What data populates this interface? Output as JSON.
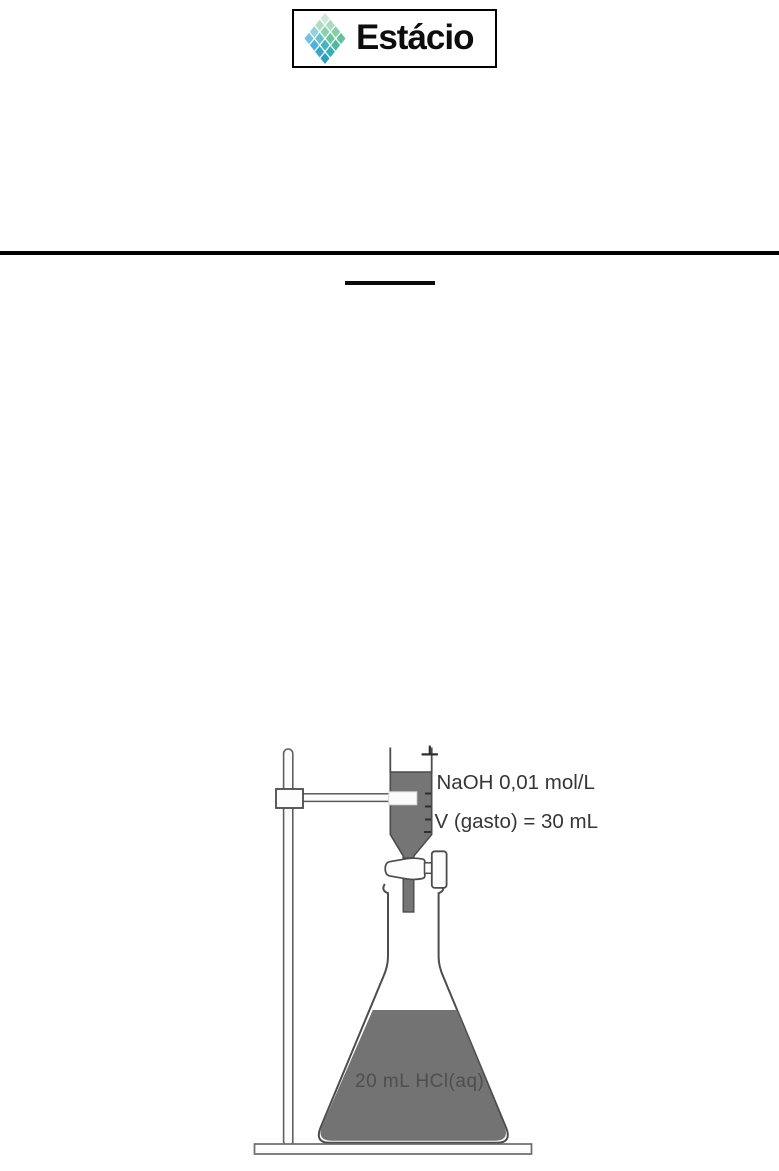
{
  "header": {
    "logo_text": "Estácio"
  },
  "figure": {
    "type": "titration-apparatus-diagram",
    "burette_label": "NaOH 0,01 mol/L",
    "volume_label": "V (gasto) = 30 mL",
    "flask_label": "20 mL HCl(aq)",
    "colors": {
      "liquid_gray": "#757575",
      "line_outline": "#4c4c4c",
      "rule_black": "#010101",
      "logo_green_light": "#cde9d8",
      "logo_green": "#67c5a0",
      "logo_blue_sky": "#6cc3e6",
      "logo_teal": "#2b9fc0"
    }
  }
}
